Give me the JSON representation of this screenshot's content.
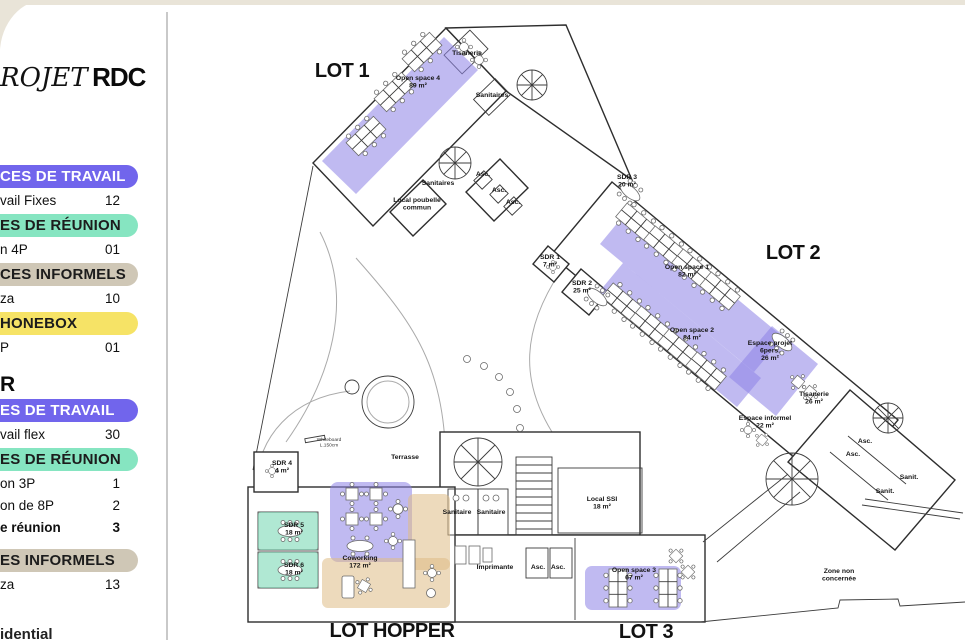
{
  "page": {
    "bg": "#ffffff",
    "frame_bg": "#e9e4d8",
    "divider": "#c9c9c9"
  },
  "sidebar": {
    "project_title_italic": "ROJET",
    "project_title_bold": "RDC",
    "pill_colors": {
      "purple": {
        "bg": "#7165ec",
        "text": "#ffffff"
      },
      "green": {
        "bg": "#86e5c1",
        "text": "#1c1c1c"
      },
      "tan": {
        "bg": "#cfc7b6",
        "text": "#1c1c1c"
      },
      "yellow": {
        "bg": "#f6e366",
        "text": "#1c1c1c"
      }
    },
    "groups": [
      {
        "header": "",
        "sections": [
          {
            "pill": "CES DE TRAVAIL",
            "color": "purple",
            "extra_gap": false,
            "rows": [
              {
                "label": "vail Fixes",
                "value": "12",
                "bold": false
              }
            ]
          },
          {
            "pill": "ES DE RÉUNION",
            "color": "green",
            "extra_gap": false,
            "rows": [
              {
                "label": "n 4P",
                "value": "01",
                "bold": false
              }
            ]
          },
          {
            "pill": "CES INFORMELS",
            "color": "tan",
            "extra_gap": false,
            "rows": [
              {
                "label": "za",
                "value": "10",
                "bold": false
              }
            ]
          },
          {
            "pill": "HONEBOX",
            "color": "yellow",
            "extra_gap": false,
            "rows": [
              {
                "label": "P",
                "value": "01",
                "bold": false
              }
            ]
          }
        ]
      },
      {
        "header": "R",
        "sections": [
          {
            "pill": "ES DE TRAVAIL",
            "color": "purple",
            "extra_gap": false,
            "rows": [
              {
                "label": "vail flex",
                "value": "30",
                "bold": false
              }
            ]
          },
          {
            "pill": "ES DE RÉUNION",
            "color": "green",
            "extra_gap": false,
            "rows": [
              {
                "label": "on 3P",
                "value": "1",
                "bold": false
              },
              {
                "label": "on de 8P",
                "value": "2",
                "bold": false
              },
              {
                "label": "e réunion",
                "value": "3",
                "bold": true
              }
            ]
          },
          {
            "pill": "ES INFORMELS",
            "color": "tan",
            "extra_gap": true,
            "rows": [
              {
                "label": "za",
                "value": "13",
                "bold": false
              }
            ]
          }
        ]
      }
    ],
    "footer": "idential"
  },
  "plan": {
    "highlight_colors": {
      "workspace": "#8c82e6",
      "meeting": "#6fd6ae",
      "informal": "#dfbc85"
    },
    "lots": [
      {
        "label": "LOT 1",
        "x": 342,
        "y": 77
      },
      {
        "label": "LOT 2",
        "x": 793,
        "y": 259
      },
      {
        "label": "LOT HOPPER",
        "x": 392,
        "y": 637
      },
      {
        "label": "LOT 3",
        "x": 646,
        "y": 638
      }
    ],
    "rooms": [
      {
        "lines": [
          "Open space 4",
          "89 m²"
        ],
        "x": 418,
        "y": 80,
        "tiny": false
      },
      {
        "lines": [
          "Tisanerie"
        ],
        "x": 467,
        "y": 55,
        "tiny": false
      },
      {
        "lines": [
          "Sanitaires"
        ],
        "x": 492,
        "y": 97,
        "tiny": false
      },
      {
        "lines": [
          "Sanitaires"
        ],
        "x": 438,
        "y": 185,
        "tiny": false
      },
      {
        "lines": [
          "Local poubelle",
          "commun"
        ],
        "x": 417,
        "y": 202,
        "tiny": false
      },
      {
        "lines": [
          "Asc."
        ],
        "x": 483,
        "y": 176,
        "tiny": false
      },
      {
        "lines": [
          "Asc."
        ],
        "x": 499,
        "y": 192,
        "tiny": false
      },
      {
        "lines": [
          "Asc."
        ],
        "x": 513,
        "y": 204,
        "tiny": false
      },
      {
        "lines": [
          "SDR 3",
          "20 m²"
        ],
        "x": 627,
        "y": 179,
        "tiny": false
      },
      {
        "lines": [
          "SDR 1",
          "7 m²"
        ],
        "x": 550,
        "y": 259,
        "tiny": false
      },
      {
        "lines": [
          "SDR 2",
          "25 m²"
        ],
        "x": 582,
        "y": 285,
        "tiny": false
      },
      {
        "lines": [
          "Open space 1",
          "82 m²"
        ],
        "x": 687,
        "y": 269,
        "tiny": false
      },
      {
        "lines": [
          "Open space 2",
          "84 m²"
        ],
        "x": 692,
        "y": 332,
        "tiny": false
      },
      {
        "lines": [
          "Espace projet",
          "6pers.",
          "26 m²"
        ],
        "x": 770,
        "y": 345,
        "tiny": false
      },
      {
        "lines": [
          "Tisanerie",
          "26 m²"
        ],
        "x": 814,
        "y": 396,
        "tiny": false
      },
      {
        "lines": [
          "Espace informel",
          "22 m²"
        ],
        "x": 765,
        "y": 420,
        "tiny": false
      },
      {
        "lines": [
          "Asc."
        ],
        "x": 865,
        "y": 443,
        "tiny": false
      },
      {
        "lines": [
          "Asc."
        ],
        "x": 853,
        "y": 456,
        "tiny": false
      },
      {
        "lines": [
          "Sanit."
        ],
        "x": 909,
        "y": 479,
        "tiny": false
      },
      {
        "lines": [
          "Sanit."
        ],
        "x": 885,
        "y": 493,
        "tiny": false
      },
      {
        "lines": [
          "Zone non",
          "concernée"
        ],
        "x": 839,
        "y": 573,
        "tiny": false
      },
      {
        "lines": [
          "Terrasse"
        ],
        "x": 405,
        "y": 459,
        "tiny": false
      },
      {
        "lines": [
          "Whiteboard",
          "L.150cm"
        ],
        "x": 329,
        "y": 441,
        "tiny": true
      },
      {
        "lines": [
          "SDR 4",
          "4 m²"
        ],
        "x": 282,
        "y": 465,
        "tiny": false
      },
      {
        "lines": [
          "SDR 5",
          "18 m²"
        ],
        "x": 294,
        "y": 527,
        "tiny": false
      },
      {
        "lines": [
          "SDR 6",
          "18 m²"
        ],
        "x": 294,
        "y": 567,
        "tiny": false
      },
      {
        "lines": [
          "Coworking",
          "172 m²"
        ],
        "x": 360,
        "y": 560,
        "tiny": false
      },
      {
        "lines": [
          "Sanitaire"
        ],
        "x": 457,
        "y": 514,
        "tiny": false
      },
      {
        "lines": [
          "Sanitaire"
        ],
        "x": 491,
        "y": 514,
        "tiny": false
      },
      {
        "lines": [
          "Local SSI",
          "18 m²"
        ],
        "x": 602,
        "y": 501,
        "tiny": false
      },
      {
        "lines": [
          "Imprimante"
        ],
        "x": 495,
        "y": 569,
        "tiny": false
      },
      {
        "lines": [
          "Asc."
        ],
        "x": 538,
        "y": 569,
        "tiny": false
      },
      {
        "lines": [
          "Asc."
        ],
        "x": 558,
        "y": 569,
        "tiny": false
      },
      {
        "lines": [
          "Open space 3",
          "67 m²"
        ],
        "x": 634,
        "y": 572,
        "tiny": false
      }
    ]
  }
}
